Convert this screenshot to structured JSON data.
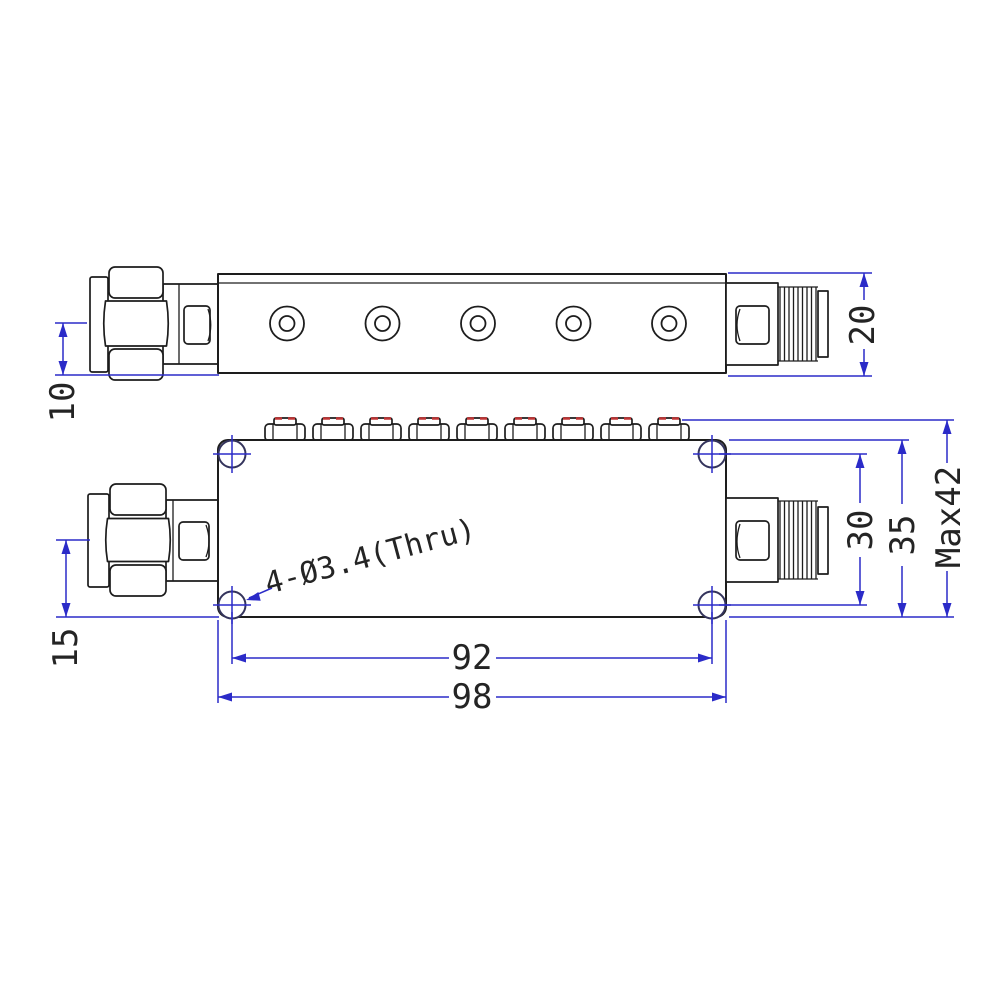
{
  "drawing": {
    "hole_note": "4-Ø3.4(Thru)",
    "side_view": {
      "dim_axis_to_base": "10",
      "dim_body_height": "20"
    },
    "plan_view": {
      "dim_axis_to_base": "15",
      "dim_mount_hole_span": "92",
      "dim_body_length": "98",
      "dim_mount_hole_vertical_span": "30",
      "dim_body_width": "35",
      "dim_max_height": "Max42"
    },
    "counts": {
      "side_view_cover_screws": 5,
      "plan_view_tuning_screws": 9,
      "plan_view_corner_holes": 4
    },
    "colors": {
      "geometry_line": "#1d1d1d",
      "dimension_line": "#2b2bc8",
      "tuning_screw_mark": "#c03434",
      "background": "#ffffff"
    }
  }
}
